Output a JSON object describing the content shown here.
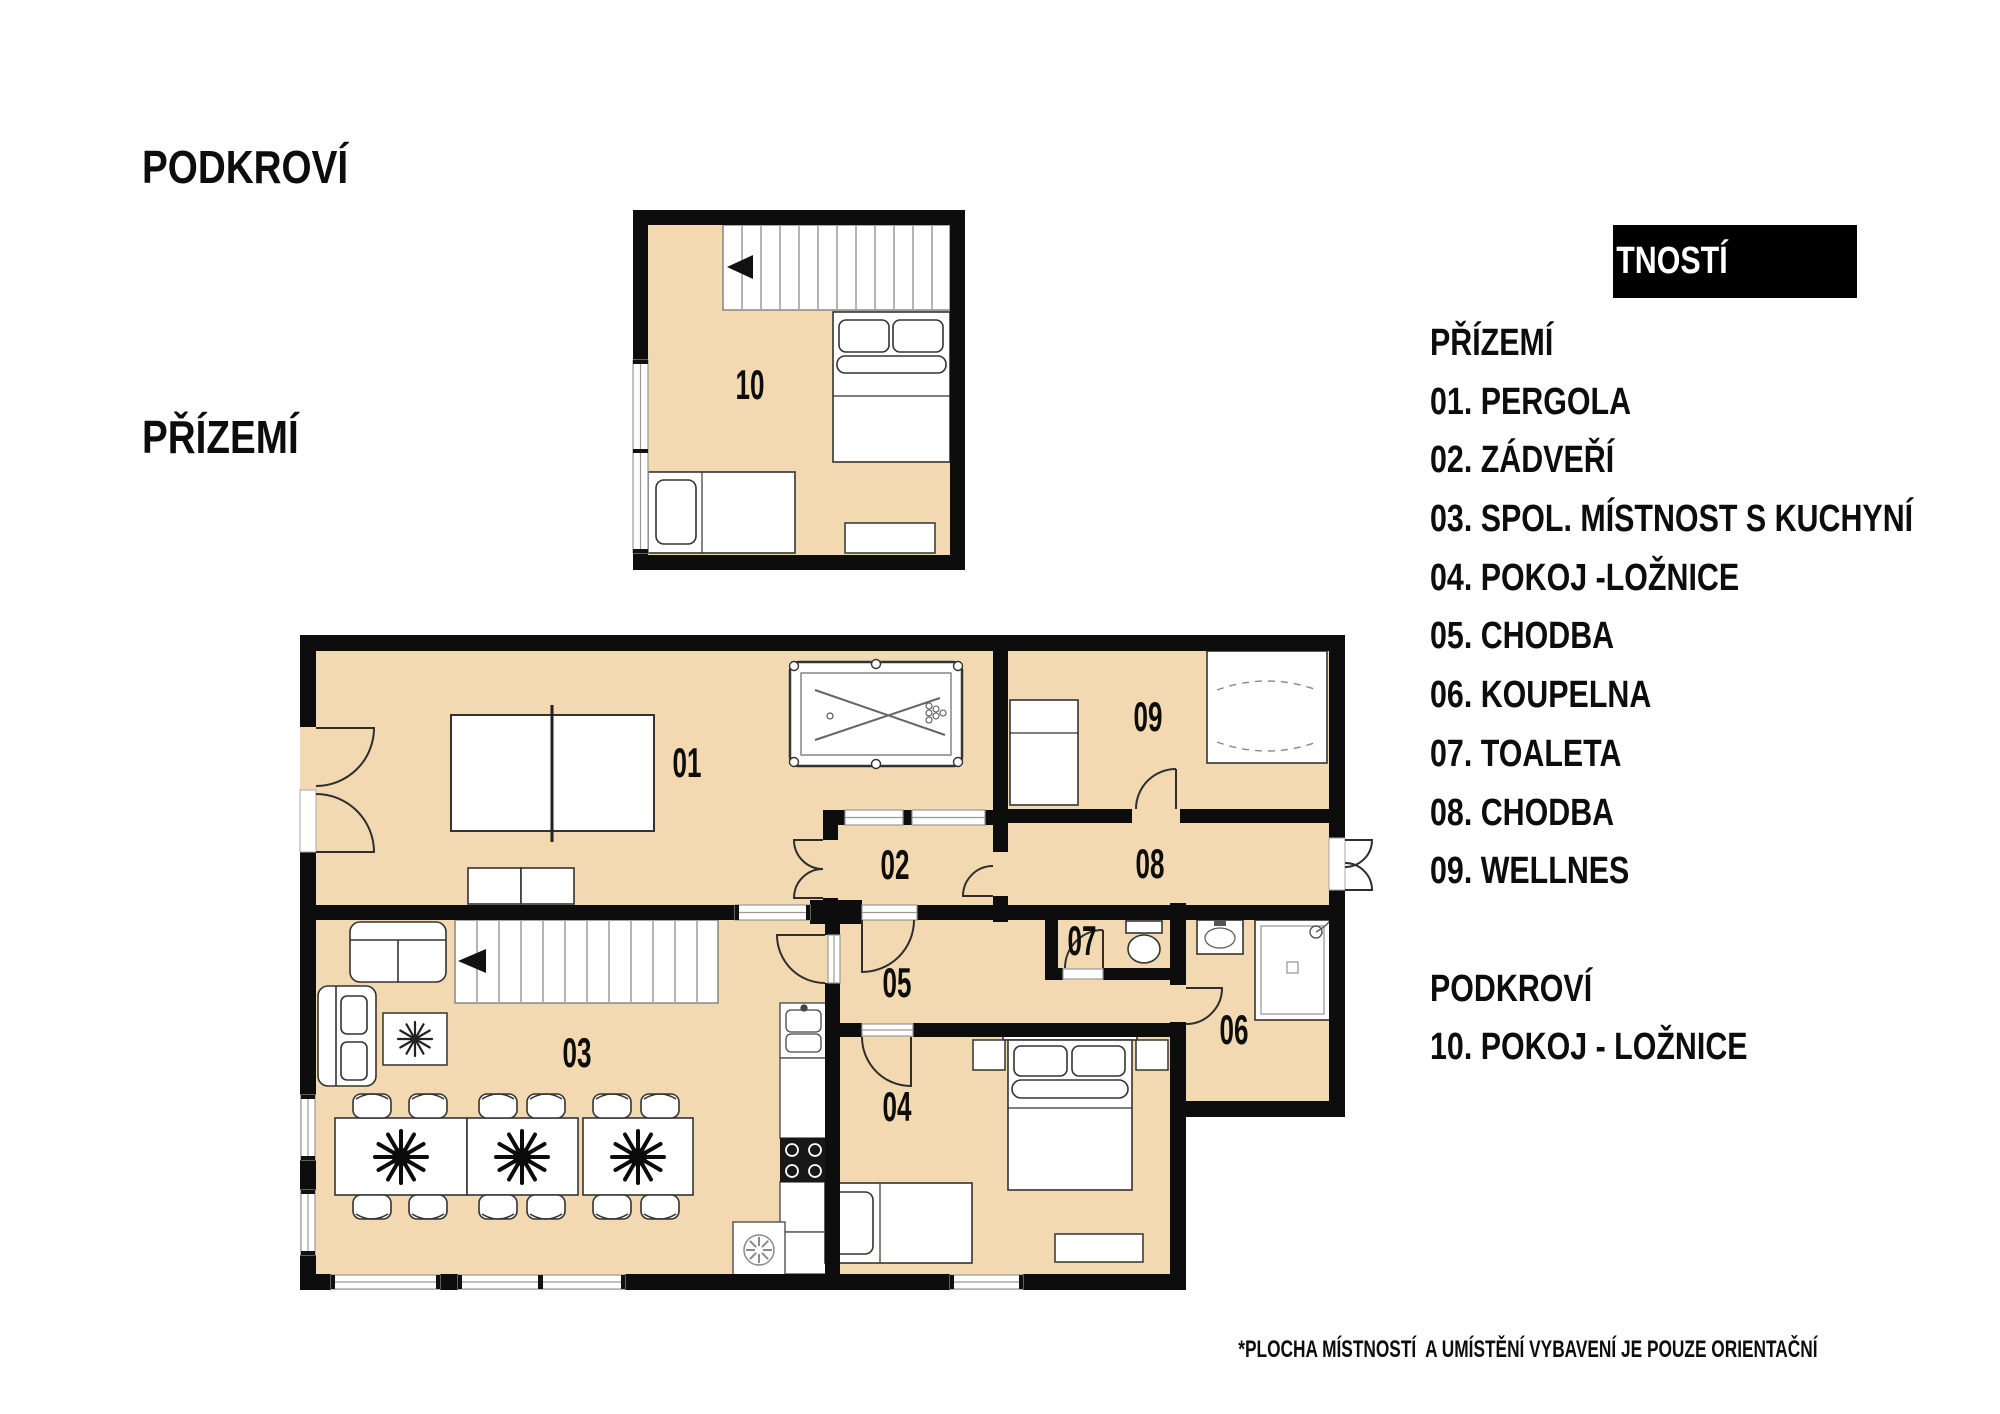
{
  "titles": {
    "attic": "PODKROVÍ",
    "ground": "PŘÍZEMÍ"
  },
  "legend": {
    "banner_label": "TNOSTÍ",
    "rows": [
      "PŘÍZEMÍ",
      "01. PERGOLA",
      "02. ZÁDVEŘÍ",
      "03. SPOL. MÍSTNOST S KUCHYNÍ",
      "04. POKOJ -LOŽNICE",
      "05. CHODBA",
      "06. KOUPELNA",
      "07. TOALETA",
      "08. CHODBA",
      "09. WELLNES",
      "",
      "PODKROVÍ",
      "10. POKOJ - LOŽNICE"
    ]
  },
  "rooms": {
    "r01": "01",
    "r02": "02",
    "r03": "03",
    "r04": "04",
    "r05": "05",
    "r06": "06",
    "r07": "07",
    "r08": "08",
    "r09": "09",
    "r10": "10"
  },
  "footnote": "*PLOCHA MÍSTNOSTÍ  A UMÍSTĚNÍ VYBAVENÍ JE POUZE ORIENTAČNÍ",
  "colors": {
    "floor": "#f2d9b1",
    "wall": "#0d0d0d",
    "banner_bg": "#000000",
    "banner_text": "#ffffff",
    "furniture_stroke": "#333333",
    "window_gray": "#999999"
  }
}
